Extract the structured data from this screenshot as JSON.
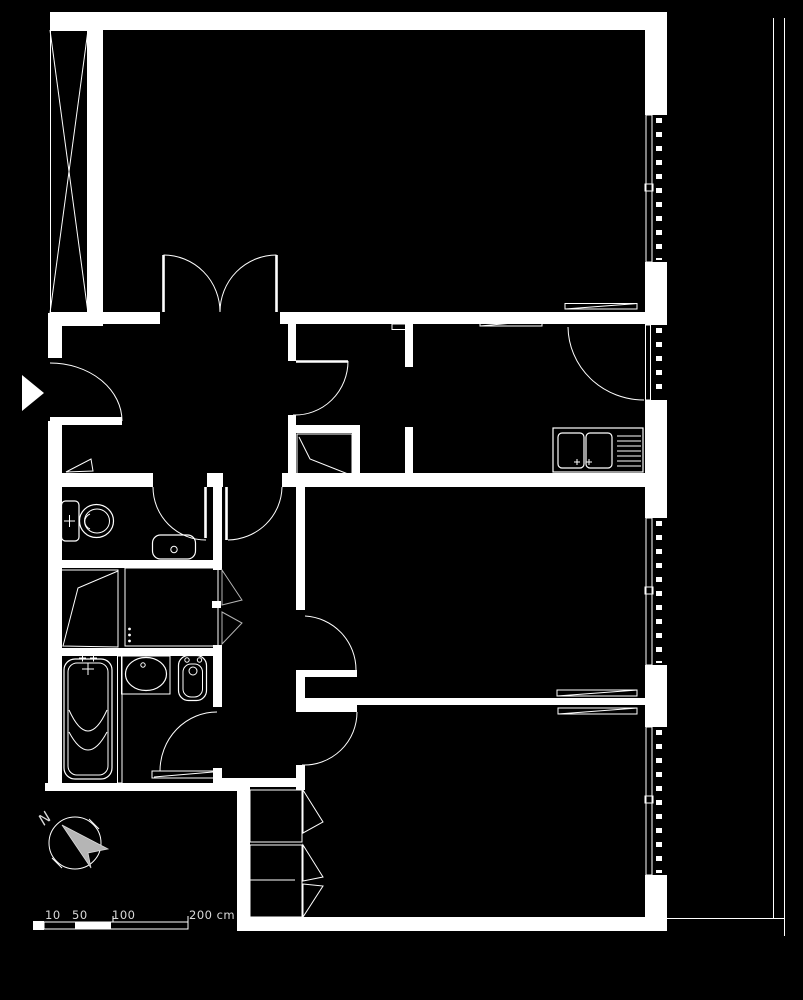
{
  "canvas": {
    "width": 803,
    "height": 1000
  },
  "colors": {
    "background": "#000000",
    "line": "#ffffff",
    "muted_gray": "#b5b5b5",
    "text": "#d9d9d9"
  },
  "compass": {
    "north_label": "N"
  },
  "scale_bar": {
    "labels": [
      "10",
      "50",
      "100",
      "200 cm"
    ]
  },
  "icons": [
    "north-arrow-icon",
    "entrance-arrow-icon",
    "window-icon",
    "door-swing-icon",
    "double-door-icon",
    "radiator-icon",
    "toilet-icon",
    "corner-basin-icon",
    "washbasin-icon",
    "bidet-icon",
    "bathtub-icon",
    "shower-icon",
    "kitchen-sink-icon",
    "wardrobe-x-icon",
    "closet-icon",
    "balcony-line-icon",
    "boiler-vent-icon"
  ]
}
